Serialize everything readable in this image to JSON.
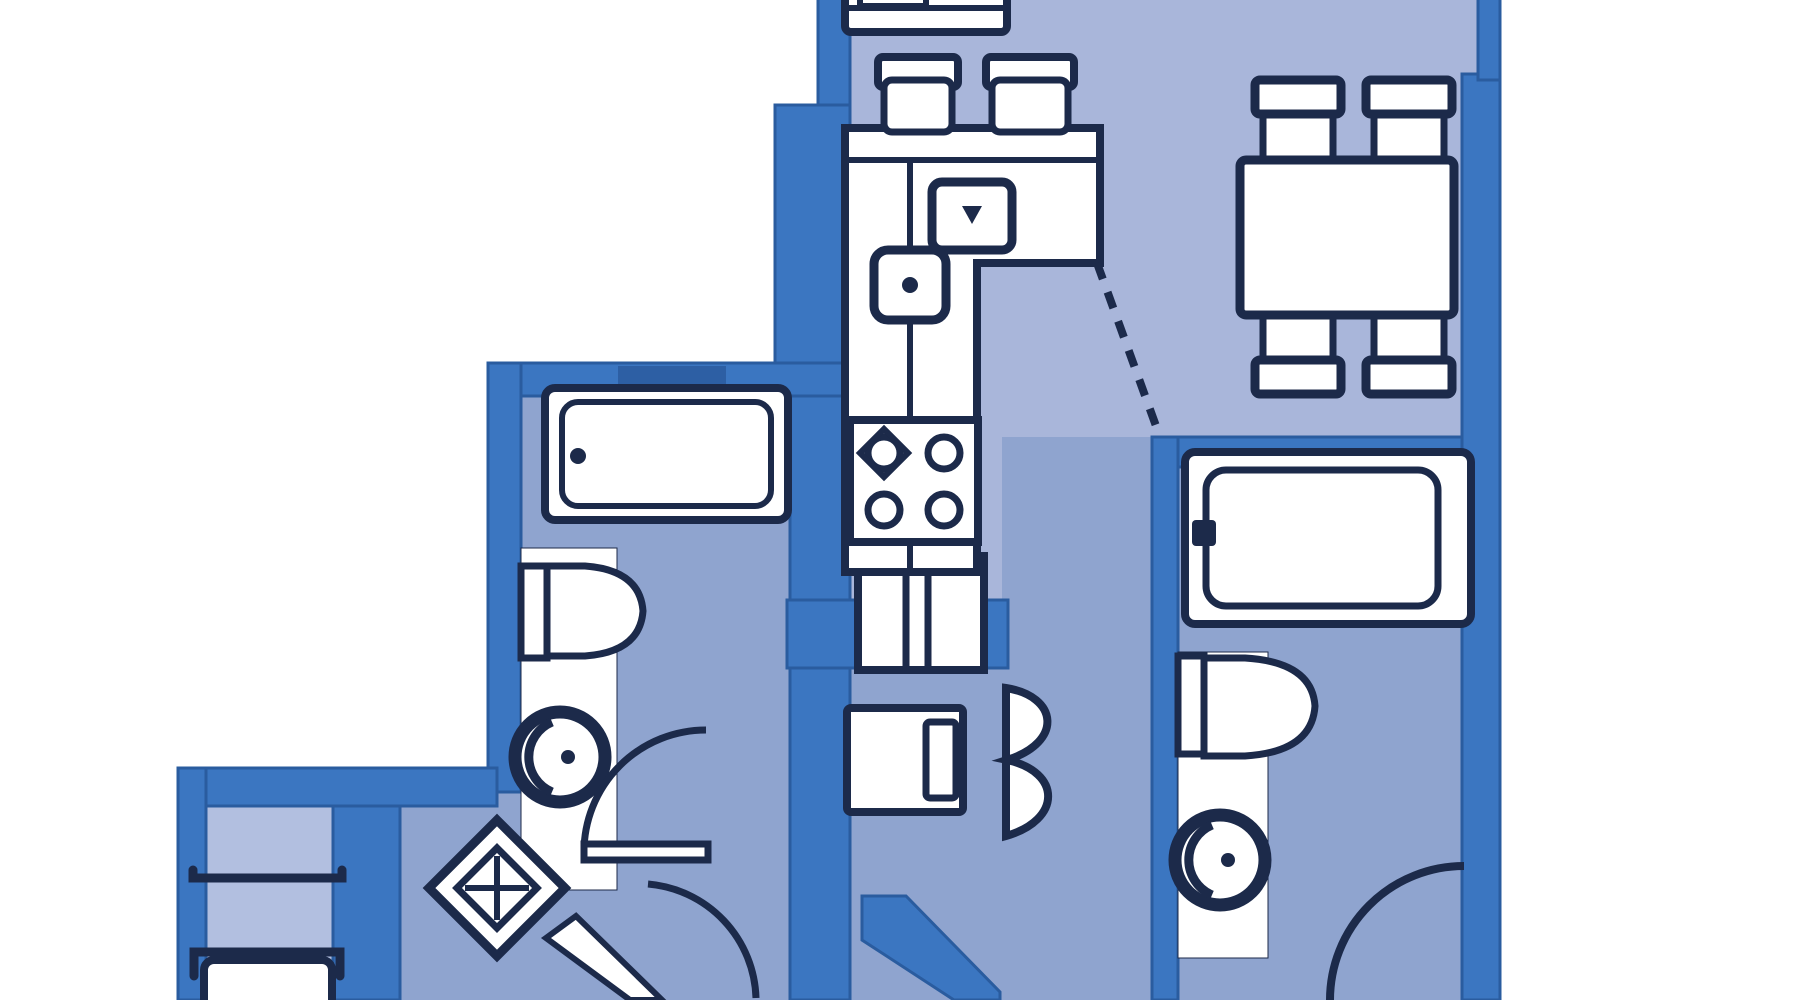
{
  "meta": {
    "title": "Apartment floor plan (blueprint, cropped top and bottom)",
    "diagram_type": "architectural-floor-plan",
    "visible_text": "none"
  },
  "colors": {
    "background": "#ffffff",
    "wall": "#3b76c1",
    "wall_edge": "#2a5c9f",
    "niche": "#2d5fa4",
    "floor_light": "#a9b6da",
    "floor_deep": "#8fa4cf",
    "floor_room": "#b2bfe0",
    "fixture_fill": "#ffffff",
    "line": "#1c2a4a"
  },
  "rooms": [
    {
      "id": "kitchen",
      "label": "Kitchen",
      "fixtures": [
        "refrigerator-appliance",
        "bar-stool x2",
        "counter-L",
        "counter-sink",
        "small-cooktop",
        "stove-4-burner",
        "pass-through-window"
      ]
    },
    {
      "id": "dining",
      "label": "Dining area (open plan)",
      "fixtures": [
        "dining-table",
        "dining-chair x4",
        "dashed-open-boundary"
      ]
    },
    {
      "id": "bathroom-left",
      "label": "Left bathroom",
      "fixtures": [
        "bathtub",
        "toilet",
        "washbasin",
        "vanity-counter",
        "swing-door"
      ]
    },
    {
      "id": "bathroom-right",
      "label": "Right bathroom",
      "fixtures": [
        "bathtub",
        "toilet",
        "washbasin",
        "vanity-counter",
        "swing-door-arc"
      ]
    },
    {
      "id": "hall",
      "label": "Entry hall",
      "fixtures": [
        "floor-medallion",
        "entry-door",
        "washing-machine",
        "folding-door",
        "diagonal-wall"
      ]
    },
    {
      "id": "bedroom",
      "label": "Bedroom (partially visible)",
      "fixtures": [
        "bed",
        "footboard-furniture"
      ]
    }
  ]
}
